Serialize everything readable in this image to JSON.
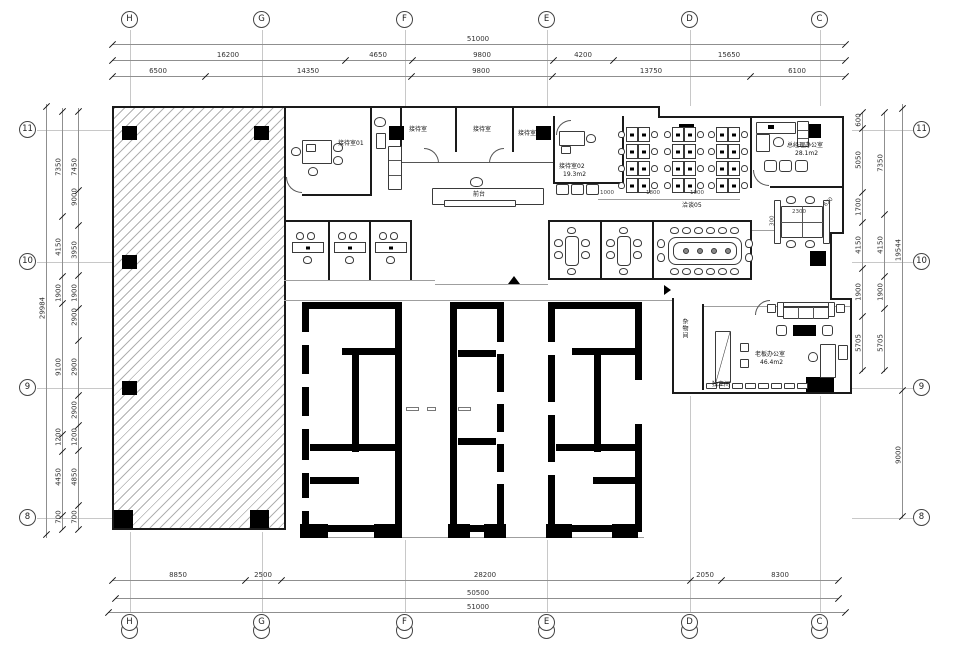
{
  "grid_bubbles": {
    "top": [
      "H",
      "G",
      "F",
      "E",
      "D",
      "C"
    ],
    "bottom": [
      "H",
      "G",
      "F",
      "E",
      "D",
      "C"
    ],
    "left": [
      "11",
      "10",
      "9",
      "8"
    ],
    "right": [
      "11",
      "10",
      "9",
      "8"
    ]
  },
  "dimensions": {
    "top_overall": "51000",
    "top_mid": [
      "16200",
      "4650",
      "9800",
      "4200",
      "15650"
    ],
    "top_inner": [
      "6500",
      "14350",
      "9800",
      "13750",
      "6100"
    ],
    "bottom_inner": [
      "8850",
      "2500",
      "28200",
      "2050",
      "8300"
    ],
    "bottom_mid": "50500",
    "bottom_overall": "51000",
    "left_overall": "29984",
    "left_outer": [
      "7350",
      "4150",
      "1900",
      "9100",
      "1200",
      "4450",
      "700"
    ],
    "left_inner": [
      "7450",
      "9000",
      "3950",
      "1900",
      "2900",
      "2900",
      "2900",
      "1200",
      "4850",
      "700"
    ],
    "right_outer": [
      "600",
      "5050",
      "1700",
      "4150",
      "1900",
      "5705"
    ],
    "right_inner": [
      "7350",
      "4150",
      "1900",
      "5705"
    ],
    "right_overall_upper": "19544",
    "right_overall_lower": "9000",
    "open_office": [
      "1000",
      "1800",
      "1000"
    ],
    "workstation": [
      "2300",
      "300",
      "620"
    ]
  },
  "labels": {
    "reception01": "接待室01",
    "reception_a": "接待室",
    "reception_b": "接待室",
    "reception_c": "接待室",
    "reception02": "接待室02",
    "reception02_area": "19.3m2",
    "front_desk": "前台",
    "meeting05": "洽谈05",
    "gm_office": "总经理办公室",
    "gm_office_area": "28.1m2",
    "storage": "杂物间",
    "boss_office": "老板办公室",
    "boss_office_area": "46.4m2",
    "private_room": "独立间"
  }
}
